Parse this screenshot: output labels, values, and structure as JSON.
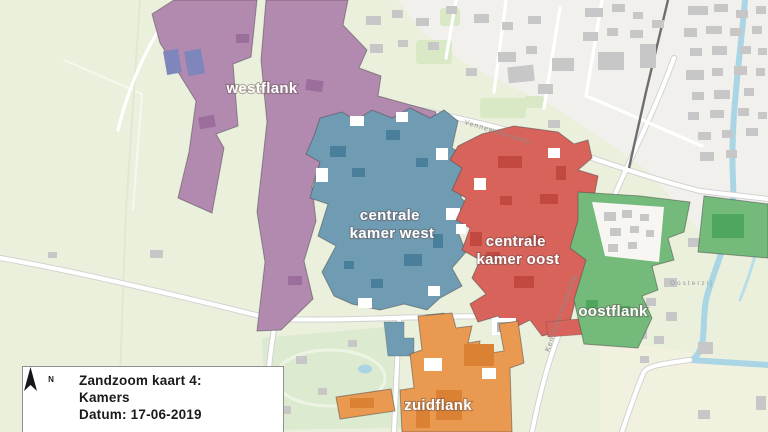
{
  "map": {
    "zones": [
      {
        "name": "westflank",
        "label_lines": [
          "westflank"
        ],
        "color": "#b28ab0",
        "dark": "#9c6e9c"
      },
      {
        "name": "centrale kamer west",
        "label_lines": [
          "centrale",
          "kamer west"
        ],
        "color": "#6f9cb3",
        "dark": "#4a7f9b"
      },
      {
        "name": "centrale kamer oost",
        "label_lines": [
          "centrale",
          "kamer oost"
        ],
        "color": "#d7635b",
        "dark": "#c2493f"
      },
      {
        "name": "oostflank",
        "label_lines": [
          "oostflank"
        ],
        "color": "#73ba7b",
        "dark": "#4fa75f"
      },
      {
        "name": "zuidflank",
        "label_lines": [
          "zuidflank"
        ],
        "color": "#ea9950",
        "dark": "#da8134"
      }
    ],
    "street_labels": [
      {
        "name": "Vennewatersweg"
      },
      {
        "name": "Kennemerstraatweg"
      },
      {
        "name": "Oosterzij"
      }
    ],
    "palette": {
      "field": "#eaf0dc",
      "urban": "#f2f0ec",
      "urban_south": "#f2f1e0",
      "park": "#d9e8c5",
      "water": "#a9d5e5",
      "building": "#c7c7c7",
      "road": "#ffffff",
      "road_casing": "#cfcfcf",
      "railway": "#6e6e6e",
      "westflank_buildings_blue": "#7f86bb"
    }
  },
  "legend": {
    "north_label": "N",
    "lines": [
      "Zandzoom kaart 4:",
      "Kamers",
      "Datum: 17-06-2019"
    ]
  }
}
